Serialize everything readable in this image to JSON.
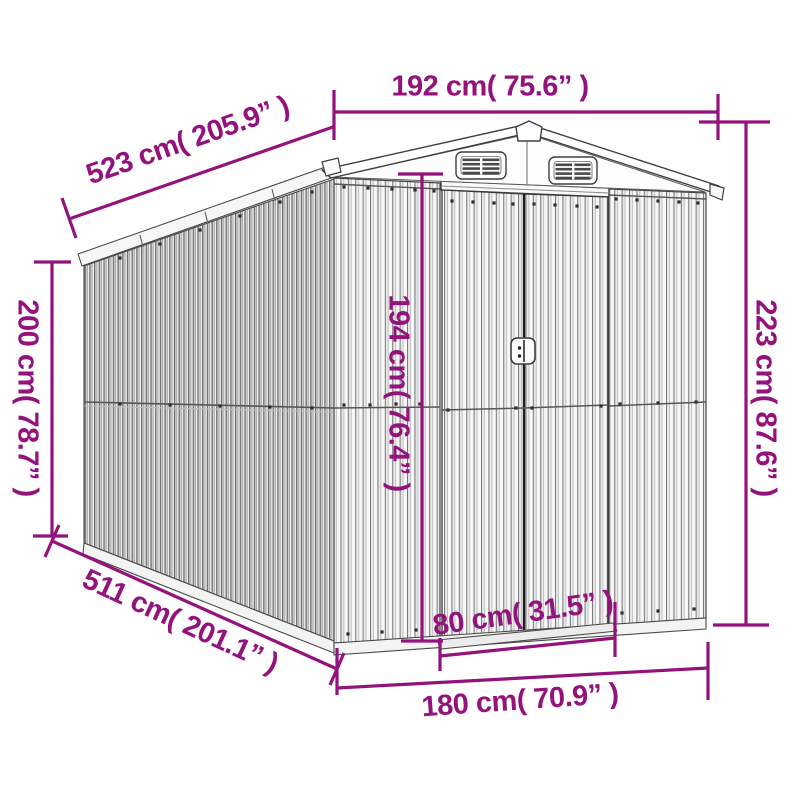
{
  "diagram": {
    "name": "garden-shed-dimension-diagram",
    "accent_color": "#93127C",
    "line_color": "#3f3f3f",
    "labels": {
      "front_width": "192 cm( 75.6” )",
      "depth_top": "523 cm( 205.9” )",
      "total_height": "223 cm( 87.6” )",
      "wall_height": "200 cm( 78.7” )",
      "door_height": "194 cm( 76.4” )",
      "door_width": "80 cm( 31.5” )",
      "base_width": "180 cm( 70.9” )",
      "depth_bottom": "511 cm( 201.1” )"
    }
  }
}
